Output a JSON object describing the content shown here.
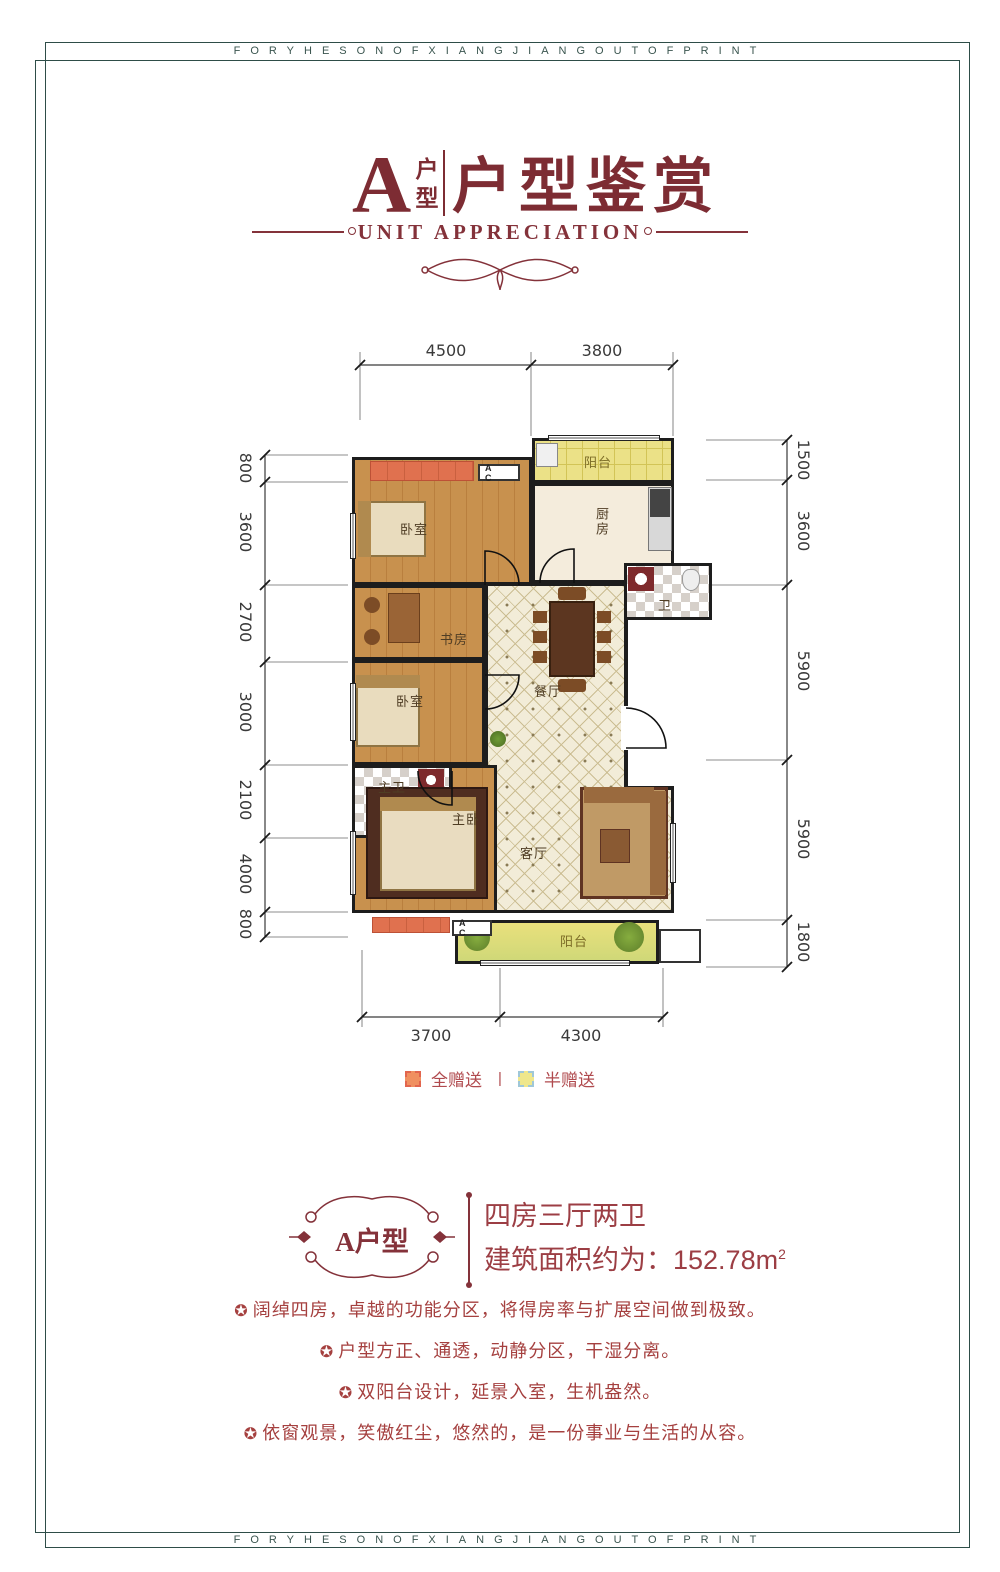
{
  "frame": {
    "band_text": "FORYHESONOFXIANGJIANGOUTOFPRINT",
    "border_color": "#2e4d48"
  },
  "header": {
    "unit_letter": "A",
    "unit_word_top": "户",
    "unit_word_bottom": "型",
    "title": "户型鉴赏",
    "subtitle": "UNIT APPRECIATION",
    "accent_color": "#84323a"
  },
  "plan": {
    "rooms": {
      "balcony_top": "阳台",
      "kitchen": "厨房",
      "bath": "卫",
      "bedroom_top": "卧室",
      "study": "书房",
      "bedroom_mid": "卧室",
      "master_bath": "主卫",
      "master_bedroom": "主卧",
      "dining": "餐厅",
      "living": "客厅",
      "balcony_bottom": "阳台"
    },
    "ac_label": "A C",
    "dims": {
      "top": [
        "4500",
        "3800"
      ],
      "left": [
        "800",
        "3600",
        "2700",
        "3000",
        "2100",
        "4000",
        "800"
      ],
      "right": [
        "1500",
        "3600",
        "5900",
        "5900",
        "1800"
      ],
      "bottom": [
        "3700",
        "4300"
      ]
    },
    "legend": {
      "full_label": "全赠送",
      "full_color": "#f09060",
      "half_label": "半赠送",
      "half_color": "#efe78c",
      "separator": "|"
    }
  },
  "info": {
    "badge": "A户型",
    "layout": "四房三厅两卫",
    "area_prefix": "建筑面积约为：152.78m",
    "area_sup": "2",
    "bullet_icon": "✪",
    "features": [
      "阔绰四房，卓越的功能分区，将得房率与扩展空间做到极致。",
      "户型方正、通透，动静分区，干湿分离。",
      "双阳台设计，延景入室，生机盎然。",
      "依窗观景，笑傲红尘，悠然的，是一份事业与生活的从容。"
    ]
  }
}
